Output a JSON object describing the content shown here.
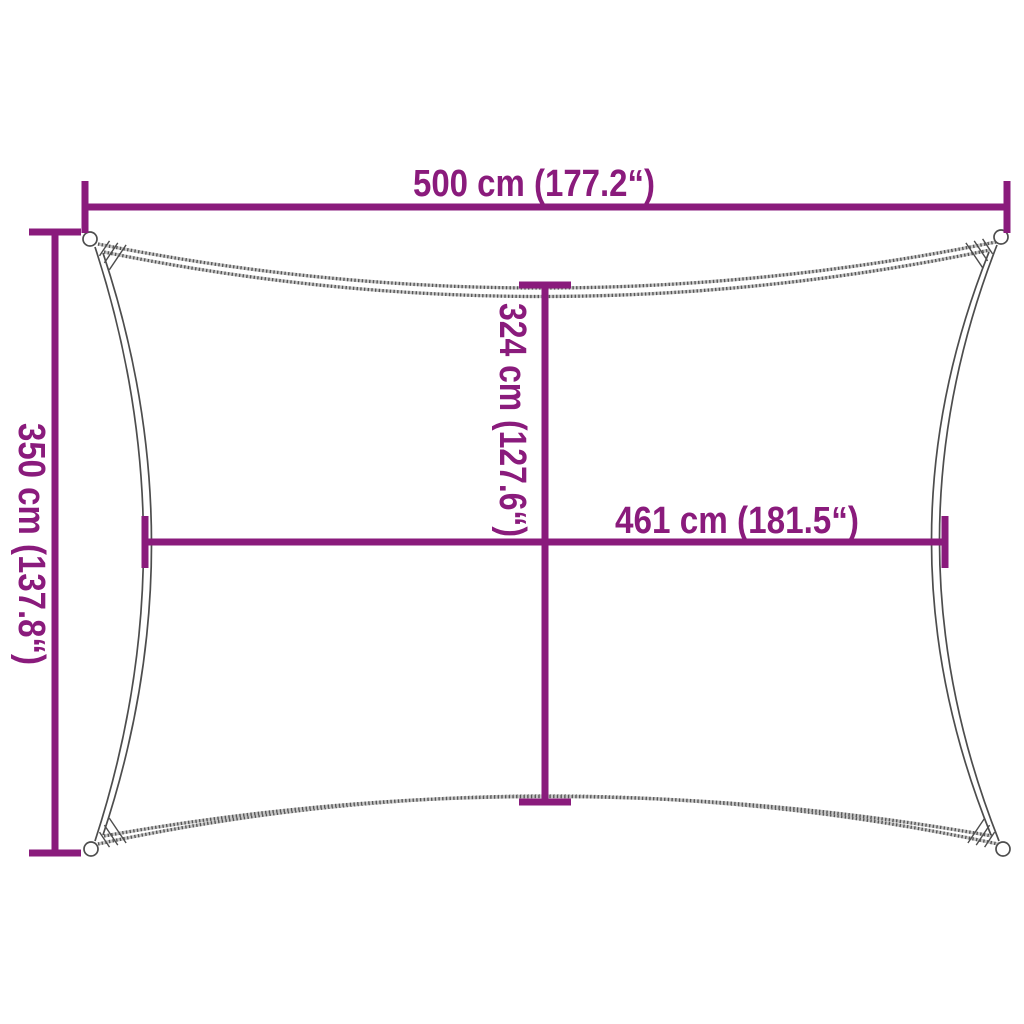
{
  "diagram": {
    "description": "Dimension drawing of a rectangular shade sail with concave edges, corner loops and stitched corners",
    "accent_color": "#8A1B7C",
    "outline_color": "#4D4D4D",
    "background_color": "#FFFFFF",
    "dimensions": {
      "top_width": {
        "label": "500 cm (177.2“)",
        "value_cm": 500,
        "value_in": 177.2,
        "position": "top edge, horizontal"
      },
      "left_height": {
        "label": "350 cm (137.8“)",
        "value_cm": 350,
        "value_in": 137.8,
        "position": "left edge, vertical (rotated text)"
      },
      "center_height": {
        "label": "324 cm (127.6“)",
        "value_cm": 324,
        "value_in": 127.6,
        "position": "center, vertical (rotated text)"
      },
      "center_width": {
        "label": "461 cm (181.5“)",
        "value_cm": 461,
        "value_in": 181.5,
        "position": "center, horizontal"
      }
    }
  }
}
